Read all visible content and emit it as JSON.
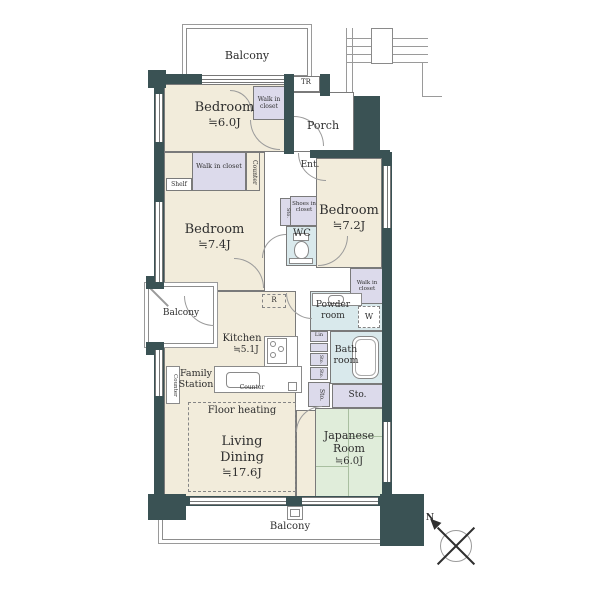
{
  "colors": {
    "wall": "#3a5254",
    "room_cream": "#f2ecdb",
    "closet_lavender": "#dcdaeb",
    "wet_blue": "#d9e9ec",
    "tatami_green": "#e0edda",
    "line": "#7a7a7a"
  },
  "plan": {
    "balcony_top": "Balcony",
    "balcony_left": "Balcony",
    "balcony_bottom": "Balcony",
    "tr": "TR",
    "porch": "Porch",
    "ent": "Ent.",
    "bedroom1": {
      "name": "Bedroom",
      "size": "≒6.0J"
    },
    "bedroom2": {
      "name": "Bedroom",
      "size": "≒7.4J"
    },
    "bedroom3": {
      "name": "Bedroom",
      "size": "≒7.2J"
    },
    "wic_top": "Walk in closet",
    "wic_mid": "Walk in closet",
    "wic_right": "Walk in closet",
    "shoes": "Shoes in closet",
    "shelf": "Shelf",
    "counter_top": "Counter",
    "counter_left": "Counter",
    "counter_kitchen": "Counter",
    "wc": "WC",
    "powder": "Powder room",
    "w": "W",
    "bath": "Bath room",
    "lin": "Lin",
    "sto_tiny": "Sto.",
    "sto_a": "Sto.",
    "sto_b": "Sto.",
    "sto_tall": "Sto.",
    "sto_wide": "Sto.",
    "kitchen": {
      "name": "Kitchen",
      "size": "≒5.1J"
    },
    "r": "R",
    "family_station": "Family Station",
    "floor_heating": "Floor heating",
    "living": {
      "l1": "Living",
      "l2": "Dining",
      "size": "≒17.6J"
    },
    "japanese": {
      "l1": "Japanese",
      "l2": "Room",
      "size": "≒6.0J"
    },
    "compass_n": "N"
  }
}
